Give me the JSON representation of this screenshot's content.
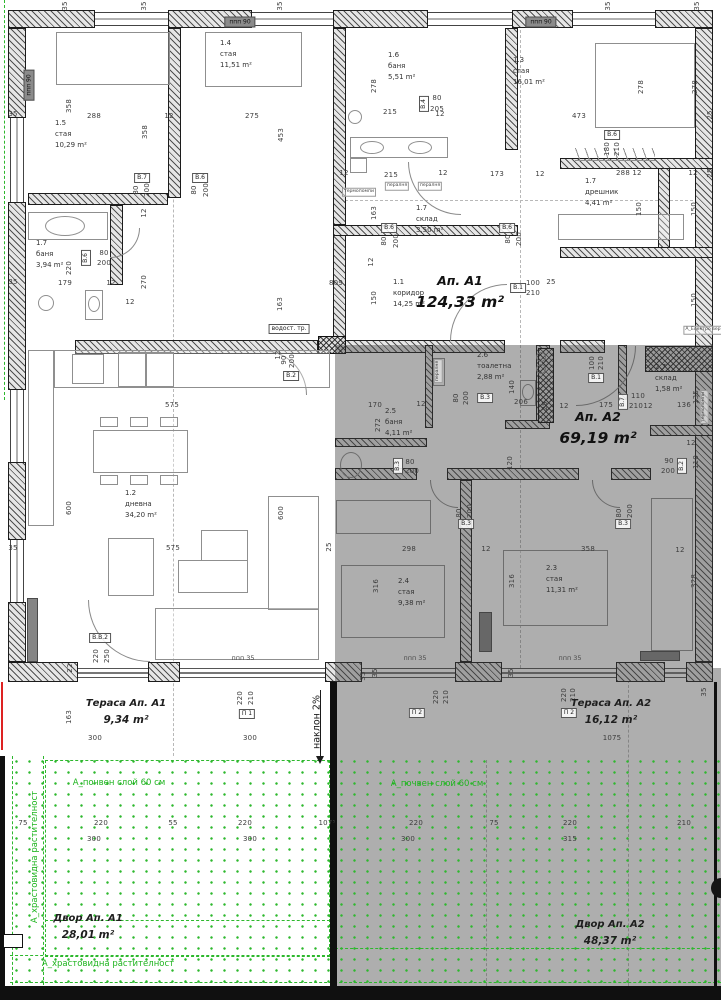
{
  "apartment_labels": [
    {
      "name": "Ап. А1",
      "area": "124,33 m²",
      "x": 460,
      "y": 271
    },
    {
      "name": "Ап. А2",
      "area": "69,19 m²",
      "x": 598,
      "y": 407
    }
  ],
  "zone_labels": [
    {
      "name": "Тераса Ап. А1",
      "area": "9,34 m²",
      "x": 126,
      "y": 696
    },
    {
      "name": "Тераса Ап. А2",
      "area": "16,12 m²",
      "x": 611,
      "y": 696
    },
    {
      "name": "Двор Ап. А1",
      "area": "28,01 m²",
      "x": 88,
      "y": 911
    },
    {
      "name": "Двор Ап. А2",
      "area": "48,37 m²",
      "x": 610,
      "y": 917
    }
  ],
  "rooms": [
    {
      "num": "1.5",
      "name": "стая",
      "area": "10,29 m²",
      "x": 55,
      "y": 118
    },
    {
      "num": "1.4",
      "name": "стая",
      "area": "11,51 m²",
      "x": 220,
      "y": 38
    },
    {
      "num": "1.6",
      "name": "баня",
      "area": "5,51 m²",
      "x": 388,
      "y": 50
    },
    {
      "num": "1.3",
      "name": "стая",
      "area": "16,01 m²",
      "x": 513,
      "y": 55
    },
    {
      "num": "1.7",
      "name": "дрешник",
      "area": "4,41 m²",
      "x": 585,
      "y": 176
    },
    {
      "num": "1.7",
      "name": "склад",
      "area": "3,50 m²",
      "x": 416,
      "y": 203
    },
    {
      "num": "1.7",
      "name": "баня",
      "area": "3,94 m²",
      "x": 36,
      "y": 238
    },
    {
      "num": "1.1",
      "name": "коридор",
      "area": "14,25 m²",
      "x": 393,
      "y": 277
    },
    {
      "num": "1.2",
      "name": "дневна",
      "area": "34,20 m²",
      "x": 125,
      "y": 488
    },
    {
      "num": "2.6",
      "name": "тоалетна",
      "area": "2,88 m²",
      "x": 477,
      "y": 350
    },
    {
      "num": "2.5",
      "name": "баня",
      "area": "4,11 m²",
      "x": 385,
      "y": 406
    },
    {
      "num": "2.7",
      "name": "склад",
      "area": "1,58 m²",
      "x": 655,
      "y": 362
    },
    {
      "num": "2.4",
      "name": "стая",
      "area": "9,38 m²",
      "x": 398,
      "y": 576
    },
    {
      "num": "2.3",
      "name": "стая",
      "area": "11,31 m²",
      "x": 546,
      "y": 563
    }
  ],
  "dims": [
    [
      "35",
      65,
      6,
      "v"
    ],
    [
      "35",
      144,
      6,
      "v"
    ],
    [
      "35",
      280,
      6,
      "v"
    ],
    [
      "35",
      608,
      6,
      "v"
    ],
    [
      "35",
      697,
      6,
      "v"
    ],
    [
      "358",
      69,
      106,
      "v"
    ],
    [
      "288",
      94,
      116,
      "h"
    ],
    [
      "12",
      169,
      116,
      "h"
    ],
    [
      "275",
      252,
      116,
      "h"
    ],
    [
      "35",
      13,
      114,
      "h"
    ],
    [
      "358",
      145,
      132,
      "v"
    ],
    [
      "453",
      281,
      135,
      "v"
    ],
    [
      "278",
      374,
      86,
      "v"
    ],
    [
      "215",
      390,
      112,
      "h"
    ],
    [
      "12",
      440,
      114,
      "h"
    ],
    [
      "80",
      437,
      98,
      "h"
    ],
    [
      "205",
      437,
      109,
      "h"
    ],
    [
      "473",
      579,
      116,
      "h"
    ],
    [
      "278",
      641,
      87,
      "v"
    ],
    [
      "278",
      695,
      87,
      "v"
    ],
    [
      "25",
      710,
      115,
      "v"
    ],
    [
      "215",
      391,
      175,
      "h"
    ],
    [
      "12",
      344,
      173,
      "h"
    ],
    [
      "12",
      443,
      173,
      "h"
    ],
    [
      "288",
      623,
      173,
      "h"
    ],
    [
      "12",
      637,
      173,
      "h"
    ],
    [
      "12",
      693,
      173,
      "h"
    ],
    [
      "25",
      710,
      173,
      "v"
    ],
    [
      "180",
      607,
      149,
      "v"
    ],
    [
      "210",
      617,
      149,
      "v"
    ],
    [
      "150",
      639,
      209,
      "v"
    ],
    [
      "150",
      694,
      209,
      "v"
    ],
    [
      "163",
      374,
      213,
      "v"
    ],
    [
      "173",
      497,
      174,
      "h"
    ],
    [
      "12",
      540,
      174,
      "h"
    ],
    [
      "80",
      136,
      190,
      "v"
    ],
    [
      "200",
      147,
      190,
      "v"
    ],
    [
      "80",
      194,
      190,
      "v"
    ],
    [
      "200",
      206,
      190,
      "v"
    ],
    [
      "12",
      144,
      213,
      "v"
    ],
    [
      "80",
      508,
      239,
      "v"
    ],
    [
      "200",
      519,
      239,
      "v"
    ],
    [
      "80",
      384,
      241,
      "v"
    ],
    [
      "200",
      396,
      241,
      "v"
    ],
    [
      "80",
      104,
      253,
      "h"
    ],
    [
      "200",
      104,
      263,
      "h"
    ],
    [
      "179",
      65,
      283,
      "h"
    ],
    [
      "220",
      69,
      268,
      "v"
    ],
    [
      "12",
      111,
      283,
      "h"
    ],
    [
      "270",
      144,
      282,
      "v"
    ],
    [
      "12",
      130,
      302,
      "h"
    ],
    [
      "809",
      336,
      283,
      "h"
    ],
    [
      "163",
      280,
      304,
      "v"
    ],
    [
      "35",
      13,
      282,
      "h"
    ],
    [
      "100",
      533,
      283,
      "h"
    ],
    [
      "25",
      551,
      282,
      "h"
    ],
    [
      "210",
      533,
      293,
      "h"
    ],
    [
      "12",
      371,
      262,
      "v"
    ],
    [
      "150",
      374,
      298,
      "v"
    ],
    [
      "150",
      694,
      300,
      "v"
    ],
    [
      "90",
      284,
      360,
      "v"
    ],
    [
      "200",
      292,
      361,
      "v"
    ],
    [
      "12",
      278,
      355,
      "v"
    ],
    [
      "575",
      172,
      405,
      "h"
    ],
    [
      "575",
      173,
      548,
      "h"
    ],
    [
      "600",
      69,
      508,
      "v"
    ],
    [
      "600",
      281,
      513,
      "v"
    ],
    [
      "35",
      13,
      548,
      "h"
    ],
    [
      "25",
      329,
      547,
      "v"
    ],
    [
      "22",
      70,
      668,
      "v"
    ],
    [
      "220",
      96,
      656,
      "v"
    ],
    [
      "250",
      107,
      656,
      "v"
    ],
    [
      "170",
      375,
      405,
      "h"
    ],
    [
      "12",
      421,
      404,
      "h"
    ],
    [
      "272",
      378,
      425,
      "v"
    ],
    [
      "140",
      512,
      387,
      "v"
    ],
    [
      "206",
      521,
      402,
      "h"
    ],
    [
      "25",
      545,
      406,
      "v"
    ],
    [
      "12",
      564,
      406,
      "h"
    ],
    [
      "175",
      606,
      405,
      "h"
    ],
    [
      "100",
      592,
      363,
      "v"
    ],
    [
      "210",
      601,
      363,
      "v"
    ],
    [
      "110",
      638,
      396,
      "h"
    ],
    [
      "210",
      636,
      406,
      "h"
    ],
    [
      "12",
      648,
      406,
      "h"
    ],
    [
      "136",
      684,
      405,
      "h"
    ],
    [
      "135",
      696,
      397,
      "v"
    ],
    [
      "90",
      669,
      461,
      "h"
    ],
    [
      "200",
      668,
      471,
      "h"
    ],
    [
      "110",
      696,
      462,
      "v"
    ],
    [
      "120",
      510,
      463,
      "v"
    ],
    [
      "80",
      456,
      398,
      "v"
    ],
    [
      "200",
      466,
      398,
      "v"
    ],
    [
      "80",
      410,
      462,
      "h"
    ],
    [
      "200",
      412,
      471,
      "h"
    ],
    [
      "80",
      459,
      513,
      "v"
    ],
    [
      "200",
      470,
      511,
      "v"
    ],
    [
      "80",
      619,
      513,
      "v"
    ],
    [
      "200",
      630,
      511,
      "v"
    ],
    [
      "298",
      409,
      549,
      "h"
    ],
    [
      "12",
      486,
      549,
      "h"
    ],
    [
      "358",
      588,
      549,
      "h"
    ],
    [
      "12",
      680,
      550,
      "h"
    ],
    [
      "316",
      376,
      586,
      "v"
    ],
    [
      "316",
      512,
      581,
      "v"
    ],
    [
      "328",
      694,
      581,
      "v"
    ],
    [
      "12",
      691,
      443,
      "h"
    ],
    [
      "35",
      375,
      673,
      "v"
    ],
    [
      "35",
      511,
      673,
      "v"
    ],
    [
      "35",
      363,
      676,
      "v"
    ],
    [
      "35",
      704,
      692,
      "v"
    ],
    [
      "163",
      69,
      717,
      "v"
    ],
    [
      "300",
      95,
      738,
      "h"
    ],
    [
      "300",
      250,
      738,
      "h"
    ],
    [
      "1075",
      612,
      738,
      "h"
    ],
    [
      "220",
      240,
      698,
      "v"
    ],
    [
      "210",
      251,
      698,
      "v"
    ],
    [
      "220",
      436,
      697,
      "v"
    ],
    [
      "210",
      446,
      697,
      "v"
    ],
    [
      "220",
      564,
      695,
      "v"
    ],
    [
      "210",
      573,
      695,
      "v"
    ],
    [
      "75",
      23,
      823,
      "h"
    ],
    [
      "220",
      101,
      823,
      "h"
    ],
    [
      "55",
      173,
      823,
      "h"
    ],
    [
      "220",
      245,
      823,
      "h"
    ],
    [
      "107⁵",
      327,
      823,
      "h"
    ],
    [
      "300",
      94,
      839,
      "h"
    ],
    [
      "300",
      250,
      839,
      "h"
    ],
    [
      "220",
      416,
      823,
      "h"
    ],
    [
      "75",
      494,
      823,
      "h"
    ],
    [
      "220",
      570,
      823,
      "h"
    ],
    [
      "210",
      684,
      823,
      "h"
    ],
    [
      "300",
      408,
      839,
      "h"
    ],
    [
      "315",
      570,
      839,
      "h"
    ]
  ],
  "door_tags": [
    [
      "В.7",
      142,
      178,
      "h"
    ],
    [
      "В.6",
      200,
      178,
      "h"
    ],
    [
      "В.4",
      424,
      104,
      "v"
    ],
    [
      "В.6",
      507,
      228,
      "h"
    ],
    [
      "В.6",
      389,
      228,
      "h"
    ],
    [
      "В.6",
      86,
      258,
      "v"
    ],
    [
      "В.6",
      612,
      135,
      "h"
    ],
    [
      "В.1",
      518,
      288,
      "h"
    ],
    [
      "В.2",
      291,
      376,
      "h"
    ],
    [
      "В.1",
      596,
      378,
      "h"
    ],
    [
      "В.7",
      623,
      402,
      "v"
    ],
    [
      "В.2",
      682,
      466,
      "v"
    ],
    [
      "В.3",
      485,
      398,
      "h"
    ],
    [
      "В.3",
      398,
      466,
      "v"
    ],
    [
      "В.3",
      466,
      524,
      "h"
    ],
    [
      "В.3",
      623,
      524,
      "h"
    ],
    [
      "В.В.2",
      100,
      638,
      "h"
    ],
    [
      "П 1",
      247,
      714,
      "h"
    ],
    [
      "П 2",
      417,
      713,
      "h"
    ],
    [
      "П 2",
      569,
      713,
      "h"
    ]
  ],
  "notes": [
    [
      "ппп 90",
      240,
      22,
      "lintel"
    ],
    [
      "ппп 90",
      541,
      22,
      "lintel"
    ],
    [
      "ппп 90",
      29,
      85,
      "lintel-v"
    ],
    [
      "ппп 35",
      243,
      658,
      "plain"
    ],
    [
      "ппп 35",
      415,
      658,
      "plain"
    ],
    [
      "ппп 35",
      570,
      658,
      "plain"
    ],
    [
      "термопомпи",
      359,
      192,
      "tiny"
    ],
    [
      "пералня",
      397,
      186,
      "tiny"
    ],
    [
      "пералня",
      430,
      186,
      "tiny"
    ],
    [
      "термопомпи",
      704,
      407,
      "tiny-v"
    ],
    [
      "пералня",
      438,
      371,
      "tiny-v"
    ],
    [
      "водост. тр.",
      289,
      329,
      "boxed"
    ],
    [
      "А_Електро вер",
      703,
      330,
      "tiny"
    ],
    [
      "наклон 2%",
      317,
      722,
      "slope-v"
    ]
  ],
  "green_notes": [
    [
      "А_почвен слой 60 см",
      119,
      783,
      "h"
    ],
    [
      "А_почвен слой 60 см",
      437,
      784,
      "h"
    ],
    [
      "А_храстовидна растителност",
      35,
      857,
      "v"
    ],
    [
      "А_храстовидна растителност",
      108,
      964,
      "h"
    ]
  ],
  "colors": {
    "wall_line": "#1c1c1c",
    "a2_overlay_gray": "#a6a6a6",
    "vegetation_green": "#2db82d",
    "dim_text": "#3c3c3c",
    "red_mark": "#d22222"
  }
}
